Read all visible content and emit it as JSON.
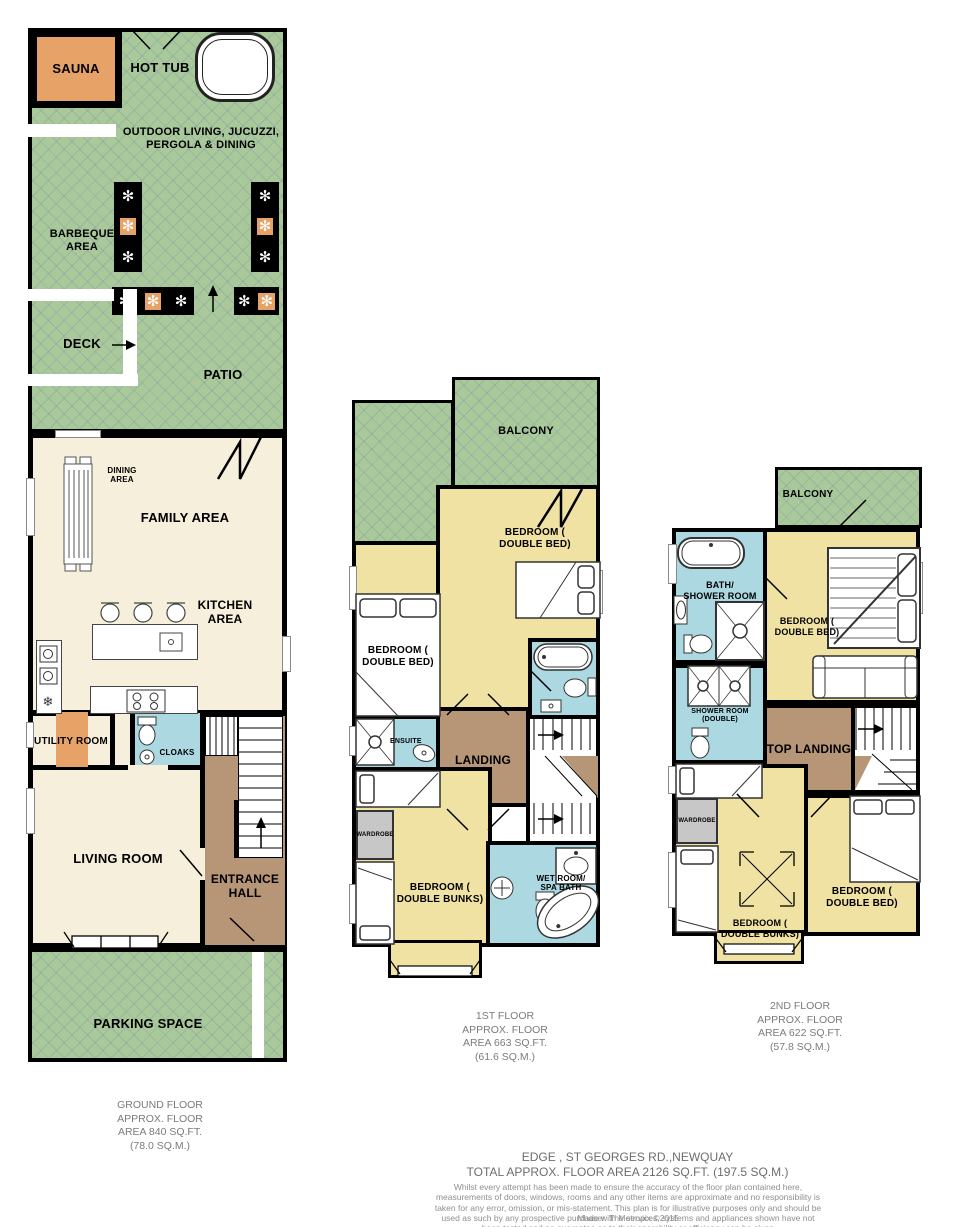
{
  "colors": {
    "outdoor_green": "#aac99b",
    "interior_cream": "#f6efdb",
    "bedroom_yellow": "#f0e2a2",
    "bath_blue": "#abd8e1",
    "hall_brown": "#b79678",
    "accent_orange": "#e7a267",
    "wardrobe_gray": "#c7c7c7",
    "wall_black": "#000000"
  },
  "icons": {
    "plant": "✻",
    "snowflake": "❄"
  },
  "ground_floor": {
    "sauna": "SAUNA",
    "hot_tub": "HOT TUB",
    "outdoor_living": "OUTDOOR LIVING, JUCUZZI,\nPERGOLA & DINING",
    "barbeque_area": "BARBEQUE\nAREA",
    "deck": "DECK",
    "patio": "PATIO",
    "dining_area": "DINING\nAREA",
    "family_area": "FAMILY AREA",
    "kitchen_area": "KITCHEN\nAREA",
    "utility_room": "UTILITY ROOM",
    "cloaks": "CLOAKS",
    "living_room": "LIVING ROOM",
    "entrance_hall": "ENTRANCE\nHALL",
    "parking_space": "PARKING SPACE",
    "area_label": "GROUND FLOOR\nAPPROX. FLOOR\nAREA 840 SQ.FT.\n(78.0 SQ.M.)"
  },
  "first_floor": {
    "balcony": "BALCONY",
    "bedroom_double_left": "BEDROOM (\nDOUBLE BED)",
    "bedroom_double_right": "BEDROOM (\nDOUBLE BED)",
    "ensuite": "ENSUITE",
    "landing": "LANDING",
    "wardrobe": "WARDROBE",
    "bedroom_bunks": "BEDROOM (\nDOUBLE BUNKS)",
    "wet_room": "WET ROOM/\nSPA BATH",
    "area_label": "1ST FLOOR\nAPPROX. FLOOR\nAREA 663 SQ.FT.\n(61.6 SQ.M.)"
  },
  "second_floor": {
    "balcony": "BALCONY",
    "bath_shower_room": "BATH/\nSHOWER ROOM",
    "bedroom_double_top": "BEDROOM (\nDOUBLE BED)",
    "shower_room_double": "SHOWER ROOM\n(DOUBLE)",
    "top_landing": "TOP LANDING",
    "wardrobe": "WARDROBE",
    "bedroom_bunks": "BEDROOM (\nDOUBLE BUNKS)",
    "bedroom_double_bottom": "BEDROOM (\nDOUBLE BED)",
    "area_label": "2ND FLOOR\nAPPROX. FLOOR\nAREA 622 SQ.FT.\n(57.8 SQ.M.)"
  },
  "footer": {
    "address": "EDGE , ST GEORGES RD.,NEWQUAY",
    "total_area": "TOTAL APPROX. FLOOR AREA 2126 SQ.FT. (197.5 SQ.M.)",
    "disclaimer": "Whilst every attempt has been made to ensure the accuracy of the floor plan contained here, measurements of doors, windows, rooms and any other items are approximate and no responsibility is taken for any error, omission, or mis-statement. This plan is for illustrative purposes only and should be used as such by any prospective purchaser. The services, systems and appliances shown have not been tested and no guarantee as to their operability or efficiency can be given",
    "credit": "Made with Metropix ©2015"
  }
}
